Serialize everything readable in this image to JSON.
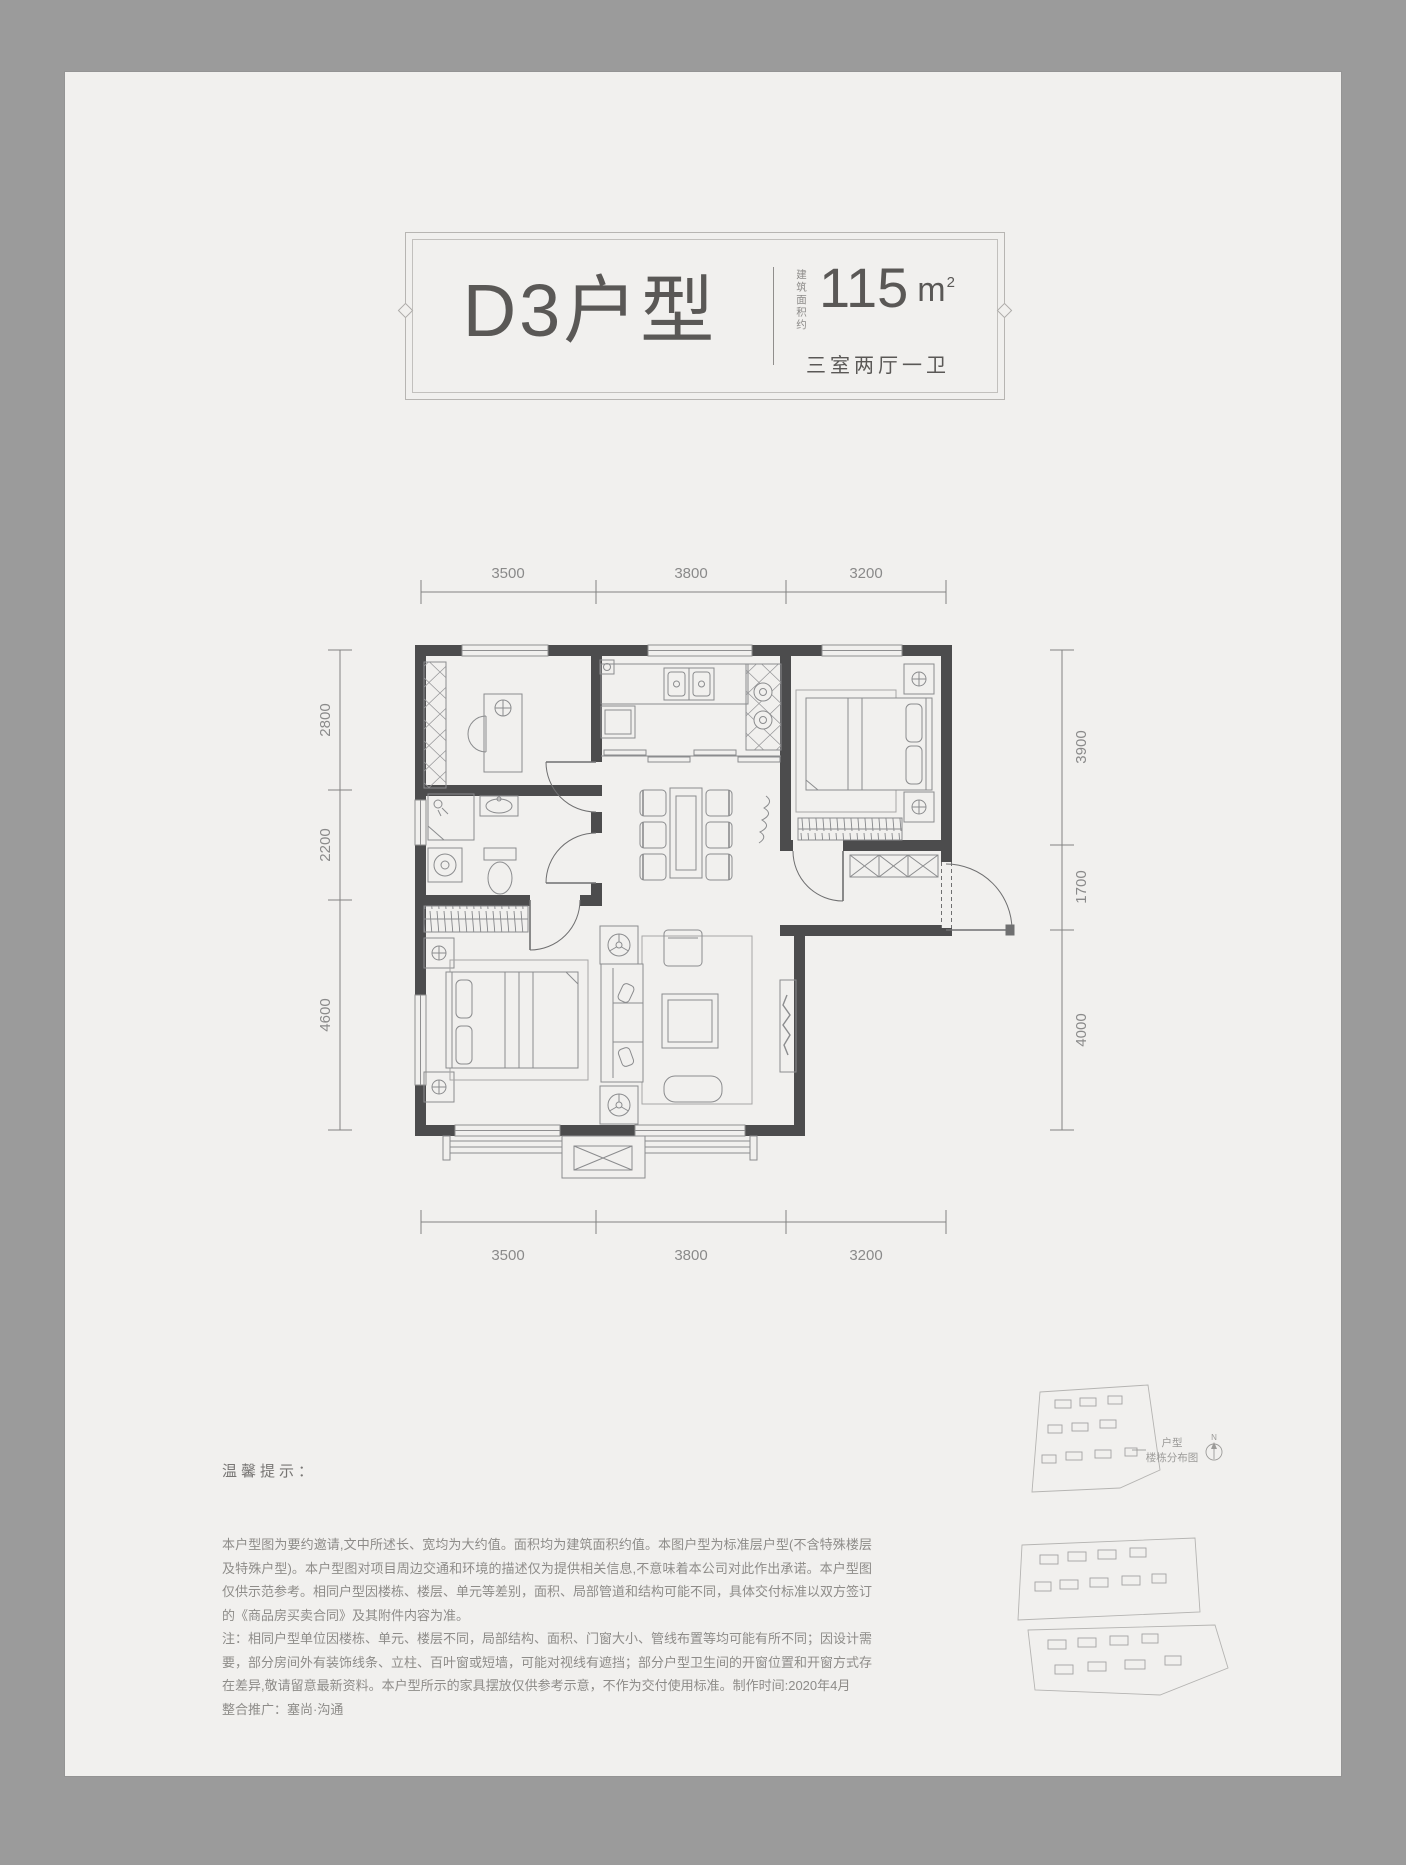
{
  "header": {
    "title": "D3户型",
    "area_label_vertical": "建筑面积约",
    "area_value": "115",
    "area_unit": "m",
    "area_sup": "2",
    "layout": "三室两厅一卫"
  },
  "plan": {
    "dims_top": [
      "3500",
      "3800",
      "3200"
    ],
    "dims_bottom": [
      "3500",
      "3800",
      "3200"
    ],
    "dims_left": [
      "2800",
      "2200",
      "4600"
    ],
    "dims_right": [
      "3900",
      "1700",
      "4000"
    ]
  },
  "notes": {
    "heading": "温馨提示：",
    "para1": "本户型图为要约邀请,文中所述长、宽均为大约值。面积均为建筑面积约值。本图户型为标准层户型(不含特殊楼层及特殊户型)。本户型图对项目周边交通和环境的描述仅为提供相关信息,不意味着本公司对此作出承诺。本户型图仅供示范参考。相同户型因楼栋、楼层、单元等差别，面积、局部管道和结构可能不同，具体交付标准以双方签订的《商品房买卖合同》及其附件内容为准。",
    "para2": "注：相同户型单位因楼栋、单元、楼层不同，局部结构、面积、门窗大小、管线布置等均可能有所不同；因设计需要，部分房间外有装饰线条、立柱、百叶窗或短墙，可能对视线有遮挡；部分户型卫生间的开窗位置和开窗方式存在差异,敬请留意最新资料。本户型所示的家具摆放仅供参考示意，不作为交付使用标准。制作时间:2020年4月",
    "para3": "整合推广：塞尚·沟通"
  },
  "siteplan": {
    "label_line1": "户型",
    "label_line2": "楼栋分布图",
    "compass": "N"
  },
  "colors": {
    "page_bg": "#9b9b9b",
    "paper_bg": "#f1f0ee",
    "wall": "#4c4c4d",
    "title_text": "#5a5856",
    "dim_text": "#8a8a8a"
  }
}
